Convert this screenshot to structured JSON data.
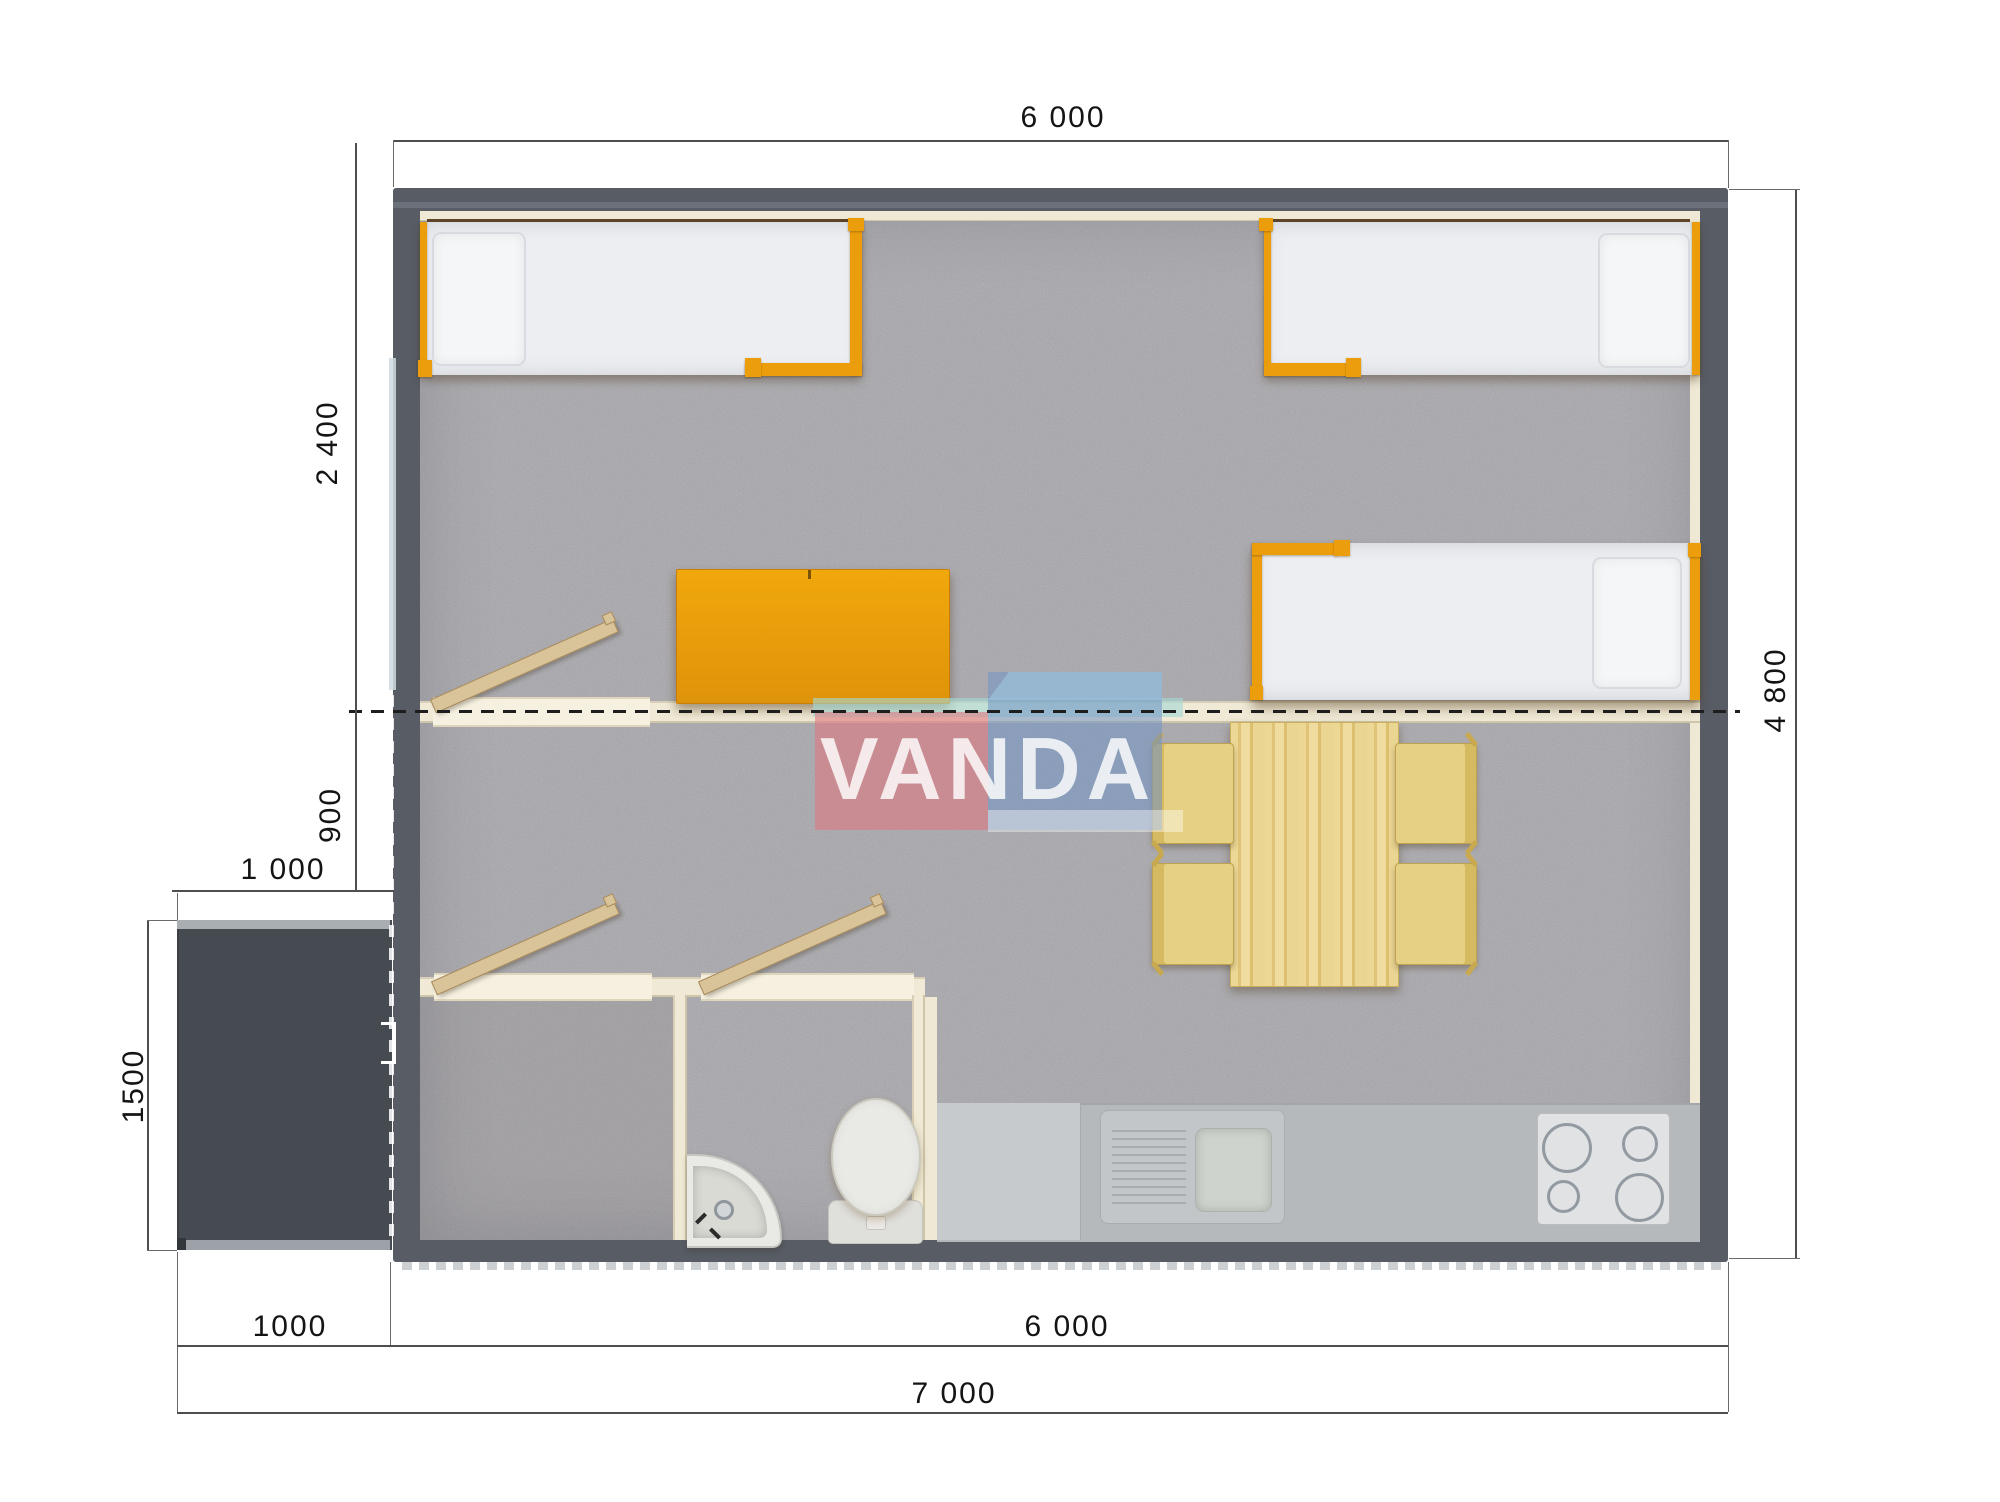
{
  "watermark": {
    "text": "VANDA"
  },
  "dimensions": {
    "top_width": "6 000",
    "right_height": "4 800",
    "left_bedroom_depth": "2 400",
    "left_hall_depth": "900",
    "porch_width": "1 000",
    "porch_depth": "1500",
    "bottom_porch_width": "1000",
    "bottom_main_width": "6 000",
    "bottom_total_width": "7 000"
  },
  "colors": {
    "wall": "#575c65",
    "porch": "#464a51",
    "carpet": "#a8a7ac",
    "partition_cream": "#efe9d5",
    "accent_orange": "#ec9d0b",
    "wood": "#e9d28c",
    "counter_gray": "#b6b9bc",
    "logo_red": "#de7880",
    "logo_blue": "#7193c4",
    "logo_teal": "#a5d8d3"
  }
}
